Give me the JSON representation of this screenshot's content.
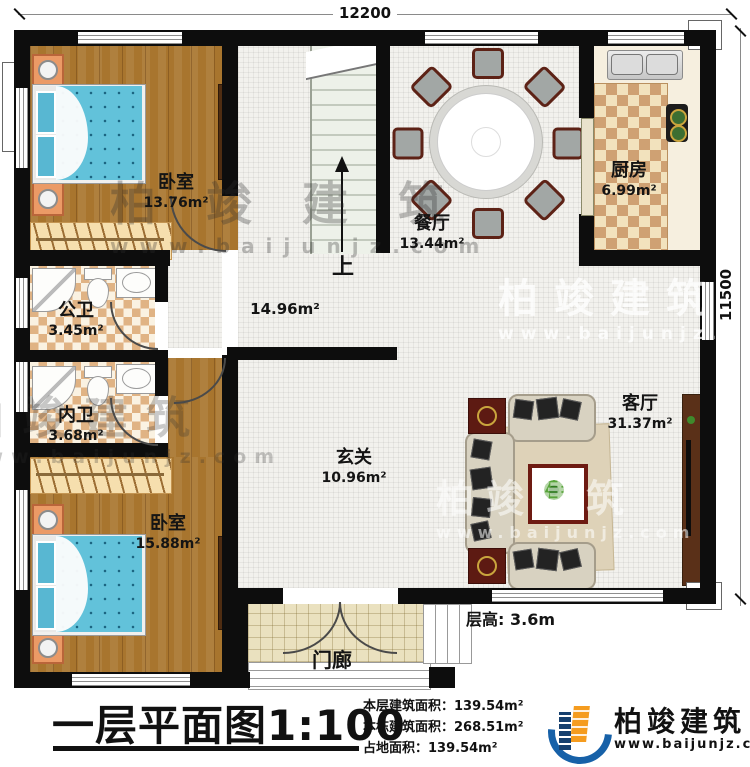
{
  "dimensions": {
    "top": "12200",
    "right": "11500"
  },
  "annotations": {
    "stairs_up": "上",
    "floor_height_label": "层高:",
    "floor_height_value": "3.6m"
  },
  "rooms": {
    "bedroom_top": {
      "name": "卧室",
      "area": "13.76m²"
    },
    "dining": {
      "name": "餐厅",
      "area": "13.44m²"
    },
    "kitchen": {
      "name": "厨房",
      "area": "6.99m²"
    },
    "bath_public": {
      "name": "公卫",
      "area": "3.45m²"
    },
    "bath_private": {
      "name": "内卫",
      "area": "3.68m²"
    },
    "hall": {
      "area": "14.96m²"
    },
    "foyer": {
      "name": "玄关",
      "area": "10.96m²"
    },
    "living": {
      "name": "客厅",
      "area": "31.37m²"
    },
    "bedroom_bottom": {
      "name": "卧室",
      "area": "15.88m²"
    },
    "porch": {
      "name": "门廊"
    }
  },
  "title_block": {
    "title": "一层平面图",
    "scale": "1:100",
    "stats": [
      {
        "label": "本层建筑面积：",
        "value": "139.54m²"
      },
      {
        "label": "本栋建筑面积：",
        "value": "268.51m²"
      },
      {
        "label": "占地面积：",
        "value": "139.54m²"
      }
    ]
  },
  "branding": {
    "logo_text": "柏竣建筑",
    "logo_url": "www.baijunjz.com",
    "watermark_text": "柏竣建筑",
    "watermark_url": "www.baijunjz.com"
  }
}
